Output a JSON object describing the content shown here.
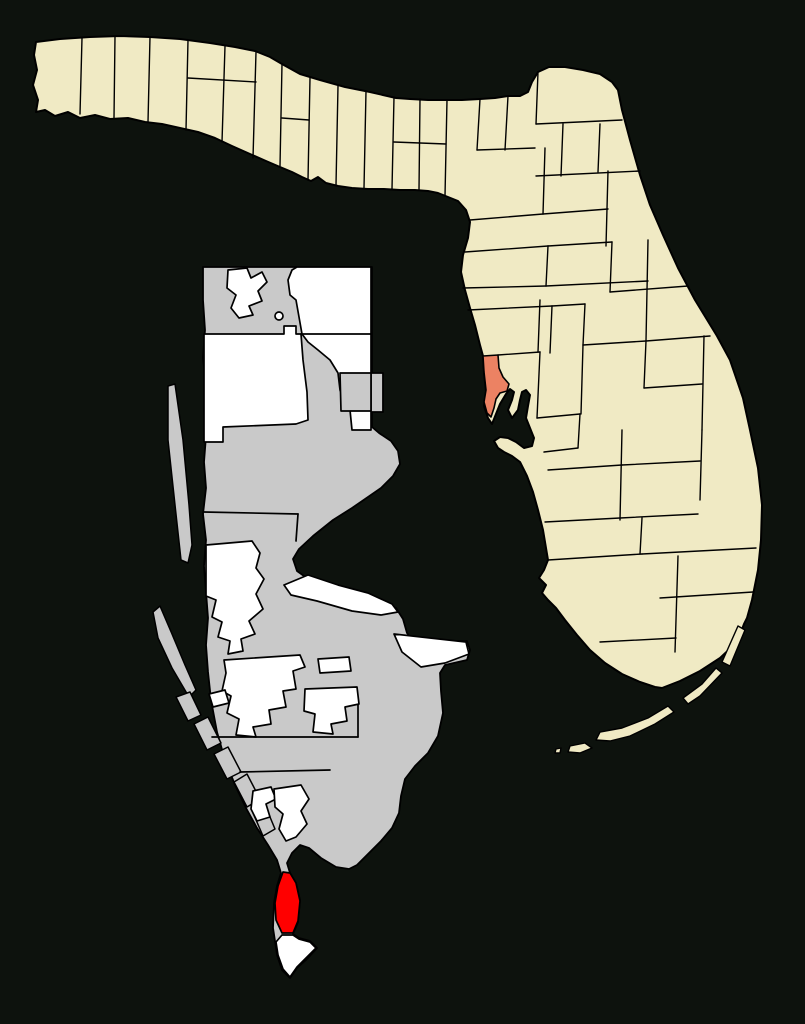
{
  "map": {
    "background_color": "#0d120d",
    "state_map": {
      "shape": "florida-with-counties",
      "county_fill": "#f0eac4",
      "border_color": "#000000",
      "highlighted_county_fill": "#ec8263"
    },
    "inset_map": {
      "shape": "pinellas-county-enlarged",
      "unincorporated_fill": "#c9c9c9",
      "incorporated_fill": "#ffffff",
      "highlighted_place_fill": "#ff0000",
      "border_color": "#000000"
    }
  }
}
